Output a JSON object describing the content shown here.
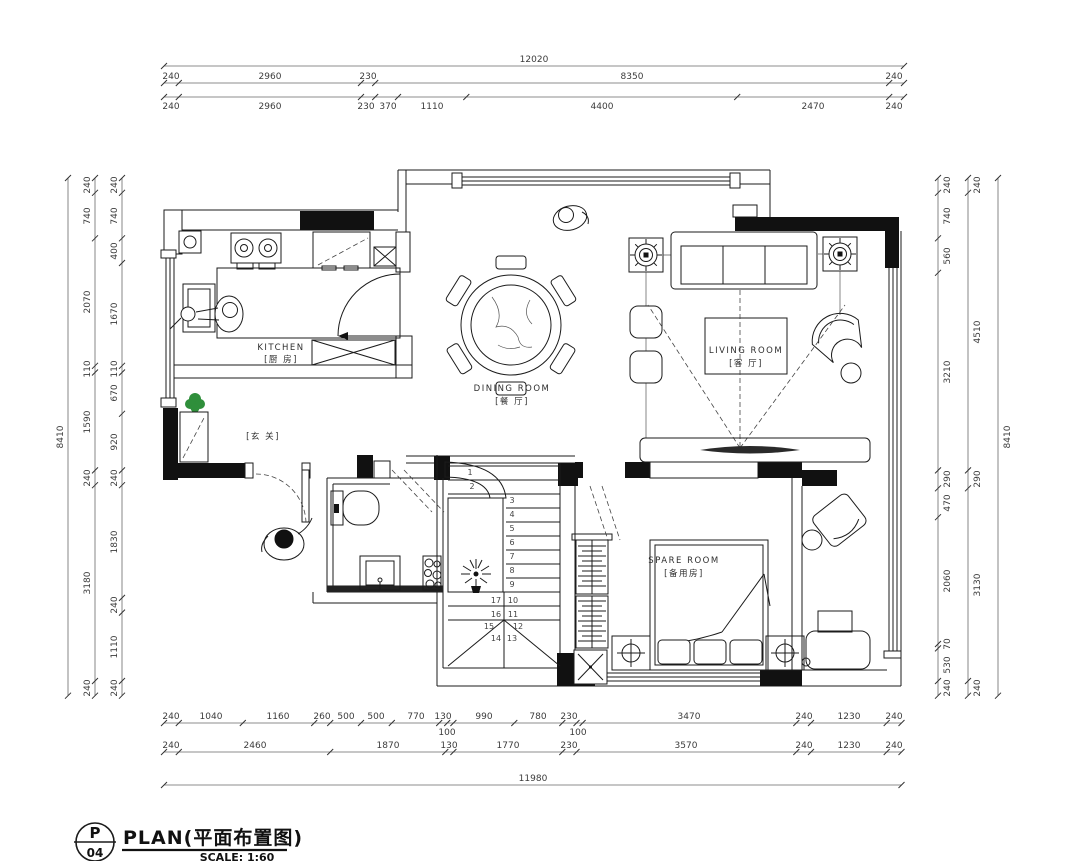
{
  "title_block": {
    "sheet_letter": "P",
    "sheet_number": "04",
    "title": "PLAN(平面布置图)",
    "scale": "SCALE: 1:60"
  },
  "rooms": {
    "kitchen": {
      "en": "KITCHEN",
      "cn": "[厨 房]"
    },
    "dining": {
      "en": "DINING ROOM",
      "cn": "[餐 厅]"
    },
    "living": {
      "en": "LIVING ROOM",
      "cn": "[客 厅]"
    },
    "foyer": {
      "cn": "[玄 关]"
    },
    "spare": {
      "en": "SPARE ROOM",
      "cn": "[备用房]"
    }
  },
  "stairs": {
    "numbers": [
      "1",
      "2",
      "3",
      "4",
      "5",
      "6",
      "7",
      "8",
      "9",
      "17",
      "10",
      "16",
      "11",
      "15",
      "12",
      "14",
      "13"
    ]
  },
  "dims": {
    "top": {
      "total": "12020",
      "row1": [
        "240",
        "2960",
        "230",
        "8350",
        "240"
      ],
      "row2": [
        "240",
        "2960",
        "230",
        "370",
        "1110",
        "4400",
        "2470",
        "240"
      ]
    },
    "bottom": {
      "total": "11980",
      "row1": [
        "240",
        "1040",
        "1160",
        "260",
        "500",
        "500",
        "770",
        "130",
        "990",
        "780",
        "230",
        "3470",
        "240",
        "1230",
        "240"
      ],
      "row1_sub": [
        "100",
        "100"
      ],
      "row2": [
        "240",
        "2460",
        "1870",
        "130",
        "1770",
        "230",
        "3570",
        "240",
        "1230",
        "240"
      ]
    },
    "left": {
      "total": "8410",
      "outer": [
        "240",
        "740",
        "2070",
        "110",
        "1590",
        "240",
        "3180",
        "240"
      ],
      "inner": [
        "240",
        "740",
        "400",
        "1670",
        "110",
        "670",
        "920",
        "240",
        "1830",
        "240",
        "1110",
        "240"
      ]
    },
    "right": {
      "total": "8410",
      "inner": [
        "240",
        "740",
        "560",
        "3210",
        "290",
        "470",
        "2060",
        "70",
        "530",
        "240"
      ],
      "middle": [
        "240",
        "4510",
        "290",
        "3130",
        "240"
      ]
    }
  },
  "colors": {
    "line": "#1b1b1b",
    "plant_green": "#2f8f3b",
    "paper": "#ffffff"
  }
}
